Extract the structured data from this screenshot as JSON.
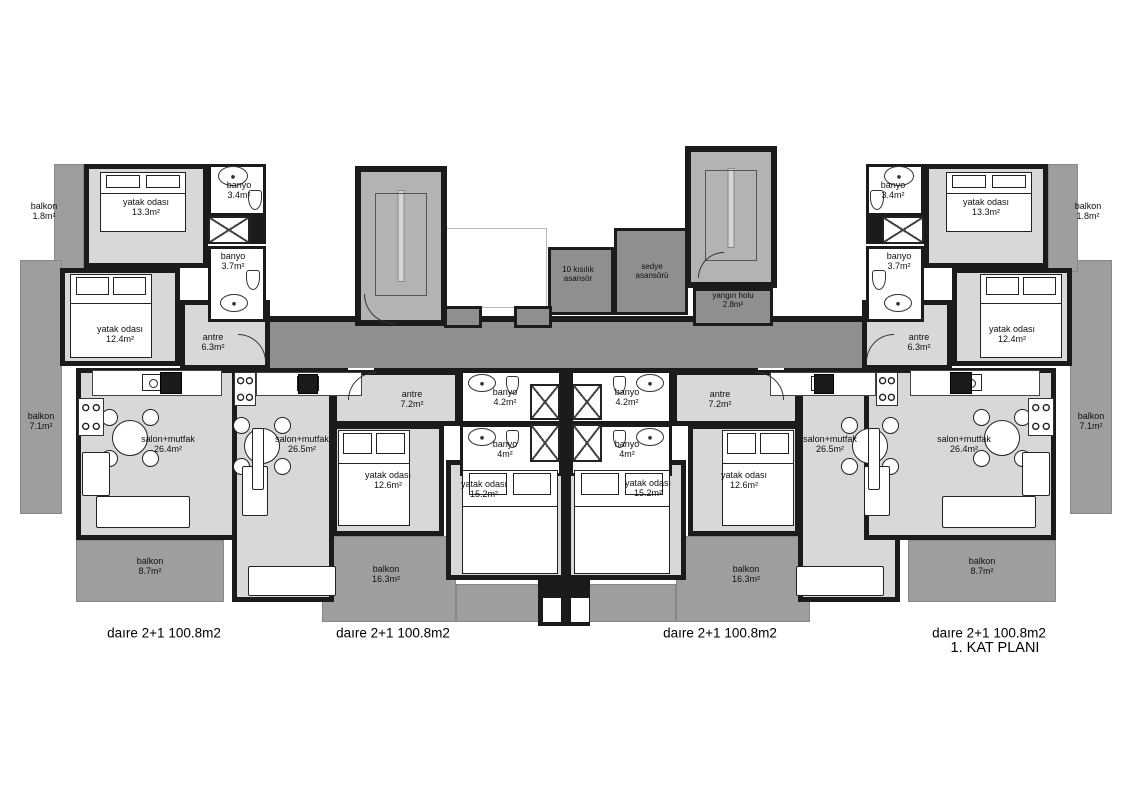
{
  "plan": {
    "width": 1132,
    "height": 800,
    "title": "1. KAT PLANI",
    "colors": {
      "wall": "#1b1b1b",
      "room": "#d8d8d8",
      "balcony": "#9e9e9e",
      "corridor": "#8f8f8f",
      "stair": "#b3b3b3",
      "bath": "#ffffff",
      "void": "#ffffff",
      "text": "#101010"
    },
    "under": [
      {
        "id": "corridor",
        "type": "corridor",
        "x": 270,
        "y": 320,
        "w": 592,
        "h": 52
      },
      {
        "id": "light-void",
        "type": "void",
        "x": 445,
        "y": 228,
        "w": 102,
        "h": 80
      },
      {
        "id": "u1-balkon-1-8",
        "type": "balcony",
        "x": 54,
        "y": 164,
        "w": 30,
        "h": 108
      },
      {
        "id": "u1-balkon-7-1",
        "type": "balcony",
        "x": 20,
        "y": 260,
        "w": 42,
        "h": 254
      },
      {
        "id": "u1-balkon-8-7",
        "type": "balcony",
        "x": 76,
        "y": 540,
        "w": 148,
        "h": 62
      },
      {
        "id": "u2-balkon-16-3",
        "type": "balcony",
        "x": 322,
        "y": 536,
        "w": 134,
        "h": 86
      },
      {
        "id": "u2-balkon-16-3b",
        "type": "balcony",
        "x": 456,
        "y": 584,
        "w": 110,
        "h": 38
      },
      {
        "id": "u3-balkon-16-3",
        "type": "balcony",
        "x": 676,
        "y": 536,
        "w": 134,
        "h": 86
      },
      {
        "id": "u3-balkon-16-3b",
        "type": "balcony",
        "x": 566,
        "y": 584,
        "w": 110,
        "h": 38
      },
      {
        "id": "u4-balkon-8-7",
        "type": "balcony",
        "x": 908,
        "y": 540,
        "w": 148,
        "h": 62
      },
      {
        "id": "u4-balkon-7-1",
        "type": "balcony",
        "x": 1070,
        "y": 260,
        "w": 42,
        "h": 254
      },
      {
        "id": "u4-balkon-1-8",
        "type": "balcony",
        "x": 1048,
        "y": 164,
        "w": 30,
        "h": 108
      }
    ],
    "walls": [
      [
        270,
        316,
        592,
        6
      ],
      [
        270,
        368,
        592,
        6
      ],
      [
        538,
        570,
        52,
        56
      ],
      [
        250,
        216,
        16,
        28
      ],
      [
        866,
        216,
        16,
        28
      ],
      [
        560,
        372,
        12,
        90
      ]
    ],
    "gaps": [
      [
        348,
        368,
        26,
        6
      ],
      [
        758,
        368,
        26,
        6
      ]
    ],
    "notches": [
      [
        543,
        598,
        18,
        24
      ],
      [
        571,
        598,
        18,
        24
      ]
    ],
    "main": [
      {
        "id": "stair-left",
        "type": "stair",
        "x": 355,
        "y": 166,
        "w": 92,
        "h": 160
      },
      {
        "id": "stair-right",
        "type": "stair",
        "x": 685,
        "y": 146,
        "w": 92,
        "h": 142
      },
      {
        "id": "u1-yatak-13-3",
        "type": "room",
        "x": 84,
        "y": 164,
        "w": 124,
        "h": 104
      },
      {
        "id": "u1-yatak-12-4",
        "type": "room",
        "x": 60,
        "y": 268,
        "w": 120,
        "h": 98
      },
      {
        "id": "u1-antre",
        "type": "room",
        "x": 180,
        "y": 300,
        "w": 90,
        "h": 70
      },
      {
        "id": "u1-banyo-3-4",
        "type": "bath",
        "x": 208,
        "y": 164,
        "w": 58,
        "h": 52
      },
      {
        "id": "u1-banyo-3-7",
        "type": "bath",
        "x": 208,
        "y": 246,
        "w": 58,
        "h": 76
      },
      {
        "id": "u1-salon",
        "type": "room",
        "x": 76,
        "y": 368,
        "w": 192,
        "h": 172
      },
      {
        "id": "u2-salon",
        "type": "room",
        "x": 232,
        "y": 370,
        "w": 102,
        "h": 232
      },
      {
        "id": "u2-antre",
        "type": "room",
        "x": 332,
        "y": 370,
        "w": 128,
        "h": 56
      },
      {
        "id": "u2-yatak-12-6",
        "type": "room",
        "x": 332,
        "y": 424,
        "w": 112,
        "h": 112
      },
      {
        "id": "u2-yatak-15-2",
        "type": "room",
        "x": 446,
        "y": 460,
        "w": 120,
        "h": 120
      },
      {
        "id": "u2-banyo-4-2",
        "type": "bath",
        "x": 460,
        "y": 370,
        "w": 102,
        "h": 54
      },
      {
        "id": "u2-banyo-4",
        "type": "bath",
        "x": 460,
        "y": 424,
        "w": 102,
        "h": 52
      },
      {
        "id": "u3-salon",
        "type": "room",
        "x": 798,
        "y": 370,
        "w": 102,
        "h": 232
      },
      {
        "id": "u3-antre",
        "type": "room",
        "x": 672,
        "y": 370,
        "w": 128,
        "h": 56
      },
      {
        "id": "u3-yatak-12-6",
        "type": "room",
        "x": 688,
        "y": 424,
        "w": 112,
        "h": 112
      },
      {
        "id": "u3-yatak-15-2",
        "type": "room",
        "x": 566,
        "y": 460,
        "w": 120,
        "h": 120
      },
      {
        "id": "u3-banyo-4-2",
        "type": "bath",
        "x": 570,
        "y": 370,
        "w": 102,
        "h": 54
      },
      {
        "id": "u3-banyo-4",
        "type": "bath",
        "x": 570,
        "y": 424,
        "w": 102,
        "h": 52
      },
      {
        "id": "u4-yatak-13-3",
        "type": "room",
        "x": 924,
        "y": 164,
        "w": 124,
        "h": 104
      },
      {
        "id": "u4-yatak-12-4",
        "type": "room",
        "x": 952,
        "y": 268,
        "w": 120,
        "h": 98
      },
      {
        "id": "u4-antre",
        "type": "room",
        "x": 862,
        "y": 300,
        "w": 90,
        "h": 70
      },
      {
        "id": "u4-banyo-3-4",
        "type": "bath",
        "x": 866,
        "y": 164,
        "w": 58,
        "h": 52
      },
      {
        "id": "u4-banyo-3-7",
        "type": "bath",
        "x": 866,
        "y": 246,
        "w": 58,
        "h": 76
      },
      {
        "id": "u4-salon",
        "type": "room",
        "x": 864,
        "y": 368,
        "w": 192,
        "h": 172
      },
      {
        "id": "elevator-10-person",
        "type": "corridor-box",
        "x": 548,
        "y": 247,
        "w": 66,
        "h": 68
      },
      {
        "id": "elevator-stretcher",
        "type": "corridor-box",
        "x": 614,
        "y": 228,
        "w": 74,
        "h": 87
      },
      {
        "id": "fire-hall",
        "type": "corridor-box",
        "x": 693,
        "y": 288,
        "w": 80,
        "h": 38
      },
      {
        "id": "niche-left",
        "type": "corridor-box",
        "x": 444,
        "y": 306,
        "w": 38,
        "h": 22
      },
      {
        "id": "niche-right",
        "type": "corridor-box",
        "x": 514,
        "y": 306,
        "w": 38,
        "h": 22
      }
    ],
    "labels": [
      {
        "x": 44,
        "y": 211,
        "l1": "balkon",
        "l2": "1.8m²"
      },
      {
        "x": 146,
        "y": 207,
        "l1": "yatak odası",
        "l2": "13.3m²"
      },
      {
        "x": 239,
        "y": 190,
        "l1": "banyo",
        "l2": "3.4m²"
      },
      {
        "x": 233,
        "y": 261,
        "l1": "banyo",
        "l2": "3.7m²"
      },
      {
        "x": 120,
        "y": 334,
        "l1": "yatak odası",
        "l2": "12.4m²"
      },
      {
        "x": 213,
        "y": 342,
        "l1": "antre",
        "l2": "6.3m²"
      },
      {
        "x": 41,
        "y": 421,
        "l1": "balkon",
        "l2": "7.1m²"
      },
      {
        "x": 168,
        "y": 444,
        "l1": "salon+mutfak",
        "l2": "26.4m²"
      },
      {
        "x": 150,
        "y": 566,
        "l1": "balkon",
        "l2": "8.7m²"
      },
      {
        "x": 302,
        "y": 444,
        "l1": "salon+mutfak",
        "l2": "26.5m²"
      },
      {
        "x": 412,
        "y": 399,
        "l1": "antre",
        "l2": "7.2m²"
      },
      {
        "x": 388,
        "y": 480,
        "l1": "yatak odası",
        "l2": "12.6m²"
      },
      {
        "x": 505,
        "y": 397,
        "l1": "banyo",
        "l2": "4.2m²"
      },
      {
        "x": 505,
        "y": 449,
        "l1": "banyo",
        "l2": "4m²"
      },
      {
        "x": 484,
        "y": 489,
        "l1": "yatak odası",
        "l2": "15.2m²"
      },
      {
        "x": 386,
        "y": 574,
        "l1": "balkon",
        "l2": "16.3m²"
      },
      {
        "x": 578,
        "y": 275,
        "l1": "10 kısılık",
        "l2": "asansör",
        "fs": 8
      },
      {
        "x": 652,
        "y": 272,
        "l1": "sedye",
        "l2": "asansörü",
        "fs": 8
      },
      {
        "x": 733,
        "y": 301,
        "l1": "yangın holu",
        "l2": "2.8m²",
        "fs": 8
      },
      {
        "x": 893,
        "y": 190,
        "l1": "banyo",
        "l2": "3.4m²"
      },
      {
        "x": 986,
        "y": 207,
        "l1": "yatak odası",
        "l2": "13.3m²"
      },
      {
        "x": 1088,
        "y": 211,
        "l1": "balkon",
        "l2": "1.8m²"
      },
      {
        "x": 899,
        "y": 261,
        "l1": "banyo",
        "l2": "3.7m²"
      },
      {
        "x": 1012,
        "y": 334,
        "l1": "yatak odası",
        "l2": "12.4m²"
      },
      {
        "x": 919,
        "y": 342,
        "l1": "antre",
        "l2": "6.3m²"
      },
      {
        "x": 1091,
        "y": 421,
        "l1": "balkon",
        "l2": "7.1m²"
      },
      {
        "x": 964,
        "y": 444,
        "l1": "salon+mutfak",
        "l2": "26.4m²"
      },
      {
        "x": 982,
        "y": 566,
        "l1": "balkon",
        "l2": "8.7m²"
      },
      {
        "x": 830,
        "y": 444,
        "l1": "salon+mutfak",
        "l2": "26.5m²"
      },
      {
        "x": 720,
        "y": 399,
        "l1": "antre",
        "l2": "7.2m²"
      },
      {
        "x": 744,
        "y": 480,
        "l1": "yatak odası",
        "l2": "12.6m²"
      },
      {
        "x": 627,
        "y": 397,
        "l1": "banyo",
        "l2": "4.2m²"
      },
      {
        "x": 627,
        "y": 449,
        "l1": "banyo",
        "l2": "4m²"
      },
      {
        "x": 648,
        "y": 488,
        "l1": "yatak odası",
        "l2": "15.2m²"
      },
      {
        "x": 746,
        "y": 574,
        "l1": "balkon",
        "l2": "16.3m²"
      }
    ],
    "furniture": {
      "beds": [
        [
          100,
          172,
          86,
          60
        ],
        [
          70,
          274,
          82,
          84
        ],
        [
          338,
          430,
          72,
          96
        ],
        [
          462,
          470,
          96,
          104
        ],
        [
          946,
          172,
          86,
          60
        ],
        [
          980,
          274,
          82,
          84
        ],
        [
          722,
          430,
          72,
          96
        ],
        [
          574,
          470,
          96,
          104
        ]
      ],
      "tables": [
        [
          130,
          438
        ],
        [
          262,
          446
        ],
        [
          870,
          446
        ],
        [
          1002,
          438
        ]
      ],
      "sofas": [
        [
          96,
          496,
          94,
          32
        ],
        [
          82,
          452,
          28,
          44
        ],
        [
          242,
          466,
          26,
          50
        ],
        [
          248,
          566,
          88,
          30
        ],
        [
          942,
          496,
          94,
          32
        ],
        [
          1022,
          452,
          28,
          44
        ],
        [
          864,
          466,
          26,
          50
        ],
        [
          796,
          566,
          88,
          30
        ],
        [
          252,
          428,
          12,
          62
        ],
        [
          868,
          428,
          12,
          62
        ]
      ],
      "counters": [
        [
          92,
          370,
          130,
          26
        ],
        [
          256,
          372,
          106,
          24
        ],
        [
          910,
          370,
          130,
          26
        ],
        [
          770,
          372,
          106,
          24
        ]
      ],
      "appliances": [
        [
          160,
          372,
          22,
          22
        ],
        [
          298,
          374,
          20,
          20
        ],
        [
          950,
          372,
          22,
          22
        ],
        [
          814,
          374,
          20,
          20
        ]
      ],
      "stoves": [
        [
          78,
          398,
          26,
          38
        ],
        [
          234,
          372,
          22,
          34
        ],
        [
          1028,
          398,
          26,
          38
        ],
        [
          876,
          372,
          22,
          34
        ]
      ],
      "sinks": [
        [
          218,
          166,
          30,
          20
        ],
        [
          220,
          294,
          28,
          18
        ],
        [
          468,
          374,
          28,
          18
        ],
        [
          468,
          428,
          28,
          18
        ],
        [
          884,
          166,
          30,
          20
        ],
        [
          884,
          294,
          28,
          18
        ],
        [
          636,
          374,
          28,
          18
        ],
        [
          636,
          428,
          28,
          18
        ]
      ],
      "toilets": [
        [
          248,
          190,
          14,
          20
        ],
        [
          246,
          270,
          14,
          20
        ],
        [
          506,
          376,
          13,
          18
        ],
        [
          506,
          430,
          13,
          18
        ],
        [
          870,
          190,
          14,
          20
        ],
        [
          872,
          270,
          14,
          20
        ],
        [
          613,
          376,
          13,
          18
        ],
        [
          613,
          430,
          13,
          18
        ]
      ],
      "showers": [
        [
          208,
          216,
          42,
          28
        ],
        [
          530,
          384,
          30,
          36
        ],
        [
          530,
          424,
          30,
          38
        ],
        [
          572,
          384,
          30,
          36
        ],
        [
          572,
          424,
          30,
          38
        ],
        [
          882,
          216,
          42,
          28
        ]
      ]
    },
    "arcs": [
      {
        "x": 238,
        "y": 334,
        "r": 28,
        "q": "tr"
      },
      {
        "x": 348,
        "y": 372,
        "r": 28,
        "q": "tl"
      },
      {
        "x": 756,
        "y": 372,
        "r": 28,
        "q": "tr"
      },
      {
        "x": 866,
        "y": 334,
        "r": 28,
        "q": "tl"
      },
      {
        "x": 364,
        "y": 294,
        "r": 30,
        "q": "bl"
      },
      {
        "x": 698,
        "y": 252,
        "r": 26,
        "q": "tl"
      }
    ],
    "footer": {
      "y": 633,
      "items": [
        {
          "text": "daıre 2+1 100.8m2",
          "x": 164
        },
        {
          "text": "daıre 2+1 100.8m2",
          "x": 393
        },
        {
          "text": "daıre 2+1 100.8m2",
          "x": 720
        },
        {
          "text": "daıre 2+1 100.8m2",
          "x": 989
        }
      ],
      "title": {
        "x": 995,
        "y": 648
      }
    }
  }
}
